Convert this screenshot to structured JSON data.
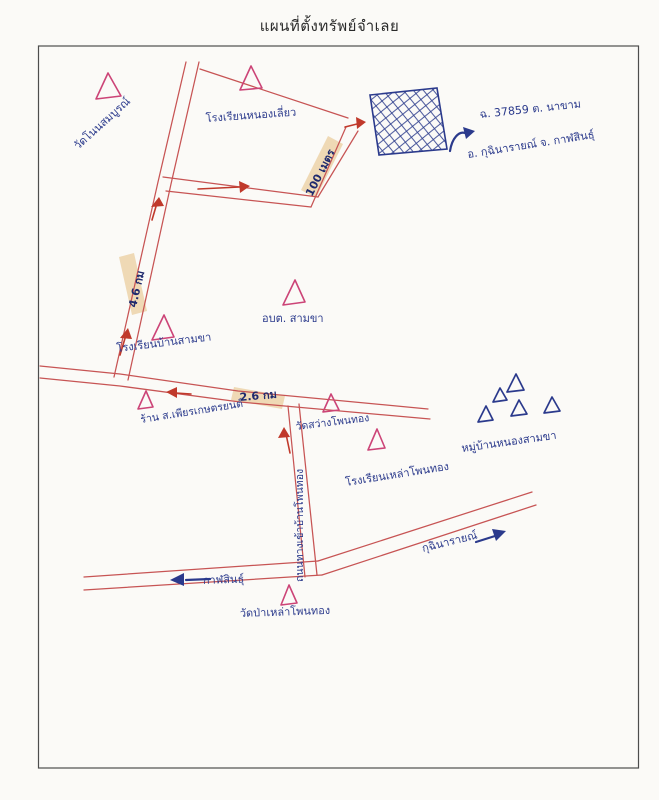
{
  "title": "แผนที่ตั้งทรัพย์จำเลย",
  "map": {
    "parcel": {
      "symbol": "hatched-rectangle",
      "line1": "ฉ. 37859  ต. นาขาม",
      "line2": "อ. กุฉินารายณ์  จ. กาฬสินธุ์"
    },
    "landmarks": {
      "wat_non": "วัดโนนสมบูรณ์",
      "school_nong": "โรงเรียนหนองเลี่ยว",
      "school_samkha": "โรงเรียนบ้านสามขา",
      "obt_samkha": "อบต. สามขา",
      "shop": "ร้าน ส.เพียรเกษตรยนต์",
      "wat_sawang": "วัดสว่างโพนทอง",
      "school_lao": "โรงเรียนเหล่าโพนทอง",
      "village": "หมู่บ้านหนองสามขา",
      "wat_pa": "วัดป่าเหล่าโพนทอง"
    },
    "distances": {
      "d100m": "100 เมตร",
      "d46km": "4.6 กม",
      "d26km": "2.6 กม"
    },
    "directions": {
      "kalasin": "กาฬสินธุ์",
      "kuchinarai": "กุฉินารายณ์"
    },
    "roads": {
      "entry_road": "ถนนทางเข้าบ้านโพนทอง"
    },
    "icons": {
      "landmark_triangle": "triangle-landmark-icon",
      "village_triangle": "triangle-house-icon"
    },
    "colors": {
      "road_red": "#c75454",
      "ink_blue": "#2b3a8c",
      "landmark_pink": "#cc4477",
      "highlight_tan": "#ecd2a9",
      "arrow_red": "#c0392b",
      "frame_gray": "#4d4d4d"
    }
  }
}
